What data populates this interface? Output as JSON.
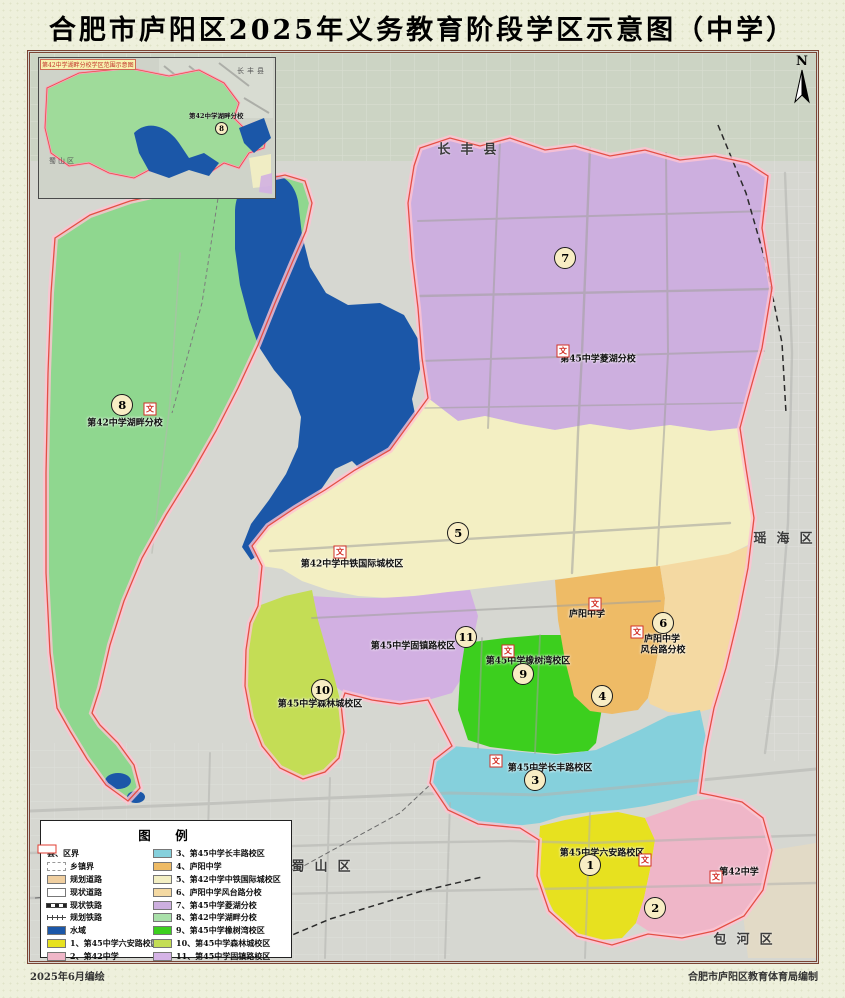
{
  "title": "合肥市庐阳区2025年义务教育阶段学区示意图（中学）",
  "north": "N",
  "footer": {
    "left": "2025年6月编绘",
    "right": "合肥市庐阳区教育体育局编制"
  },
  "inset": {
    "title": "第42中学湖畔分校学区范围示意图",
    "county": "长丰县",
    "district_left": "蜀山区",
    "label": "第42中学湖畔分校",
    "num": "8"
  },
  "counties": [
    {
      "name": "长丰县",
      "x": 472,
      "y": 148
    },
    {
      "name": "瑶海区",
      "x": 788,
      "y": 537
    },
    {
      "name": "蜀山区",
      "x": 326,
      "y": 865
    },
    {
      "name": "包河区",
      "x": 748,
      "y": 938
    }
  ],
  "school_labels": [
    {
      "text": "第42中学湖畔分校",
      "x": 125,
      "y": 422
    },
    {
      "text": "第45中学菱湖分校",
      "x": 598,
      "y": 358
    },
    {
      "text": "第42中学中铁国际城校区",
      "x": 352,
      "y": 563
    },
    {
      "text": "庐阳中学",
      "x": 587,
      "y": 613
    },
    {
      "text": "庐阳中学",
      "x": 662,
      "y": 638
    },
    {
      "text": "风台路分校",
      "x": 663,
      "y": 649
    },
    {
      "text": "第45中学固镇路校区",
      "x": 413,
      "y": 645
    },
    {
      "text": "第45中学橡树湾校区",
      "x": 528,
      "y": 660
    },
    {
      "text": "第45中学森林城校区",
      "x": 320,
      "y": 703
    },
    {
      "text": "第45中学长丰路校区",
      "x": 550,
      "y": 767
    },
    {
      "text": "第45中学六安路校区",
      "x": 602,
      "y": 852
    },
    {
      "text": "第42中学",
      "x": 739,
      "y": 871
    }
  ],
  "circles": [
    {
      "n": "1",
      "x": 590,
      "y": 865
    },
    {
      "n": "2",
      "x": 655,
      "y": 908
    },
    {
      "n": "3",
      "x": 535,
      "y": 780
    },
    {
      "n": "4",
      "x": 602,
      "y": 696
    },
    {
      "n": "5",
      "x": 458,
      "y": 533
    },
    {
      "n": "6",
      "x": 663,
      "y": 623
    },
    {
      "n": "7",
      "x": 565,
      "y": 258
    },
    {
      "n": "8",
      "x": 122,
      "y": 405
    },
    {
      "n": "9",
      "x": 523,
      "y": 674
    },
    {
      "n": "10",
      "x": 322,
      "y": 690
    },
    {
      "n": "11",
      "x": 466,
      "y": 637
    }
  ],
  "school_icon_glyph": "文",
  "school_icons": [
    {
      "x": 150,
      "y": 409
    },
    {
      "x": 340,
      "y": 552
    },
    {
      "x": 563,
      "y": 351
    },
    {
      "x": 595,
      "y": 604
    },
    {
      "x": 637,
      "y": 632
    },
    {
      "x": 508,
      "y": 651
    },
    {
      "x": 496,
      "y": 761
    },
    {
      "x": 645,
      "y": 860
    },
    {
      "x": 716,
      "y": 877
    }
  ],
  "legend": {
    "title": "图　例",
    "left": [
      {
        "label": "县、区界",
        "type": "county"
      },
      {
        "label": "乡镇界",
        "type": "town"
      },
      {
        "label": "规划道路",
        "type": "fill",
        "color": "#f0cfa0"
      },
      {
        "label": "现状道路",
        "type": "fill",
        "color": "#ffffff"
      },
      {
        "label": "现状铁路",
        "type": "rail1"
      },
      {
        "label": "规划铁路",
        "type": "rail2"
      },
      {
        "label": "水域",
        "type": "fill",
        "color": "#1b57a8"
      },
      {
        "label": "1、第45中学六安路校区",
        "type": "fill",
        "color": "#e7e11f"
      },
      {
        "label": "2、第42中学",
        "type": "fill",
        "color": "#efb6c8"
      }
    ],
    "right": [
      {
        "label": "3、第45中学长丰路校区",
        "type": "fill",
        "color": "#85d0dc"
      },
      {
        "label": "4、庐阳中学",
        "type": "fill",
        "color": "#eebb66"
      },
      {
        "label": "5、第42中学中铁国际城校区",
        "type": "fill",
        "color": "#f3efc3"
      },
      {
        "label": "6、庐阳中学风台路分校",
        "type": "fill",
        "color": "#f4d9a2"
      },
      {
        "label": "7、第45中学菱湖分校",
        "type": "fill",
        "color": "#cdafdf"
      },
      {
        "label": "8、第42中学湖畔分校",
        "type": "fill",
        "color": "#a9e0a9"
      },
      {
        "label": "9、第45中学橡树湾校区",
        "type": "fill",
        "color": "#3ccf1e"
      },
      {
        "label": "10、第45中学森林城校区",
        "type": "fill",
        "color": "#c4dd55"
      },
      {
        "label": "11、第45中学固镇路校区",
        "type": "fill",
        "color": "#d5b3e6"
      }
    ]
  },
  "colors": {
    "base": "#d6d7d1",
    "topband": "#ccd4c4",
    "water": "#1b57a8",
    "region8": "#8fd78f",
    "region7": "#cdafdf",
    "region5": "#f3efc3",
    "region11": "#d2b0e2",
    "region9": "#3ccf1e",
    "region10": "#c4dd55",
    "region4": "#eebb66",
    "region6": "#f4d9a2",
    "region3": "#85d0dc",
    "region1": "#e7e11f",
    "region2": "#efb6c8",
    "halo": "#ffc3d2",
    "boundary": "#e44f45",
    "road": "#a0a09d",
    "outside_tan": "#e8dbc0"
  }
}
